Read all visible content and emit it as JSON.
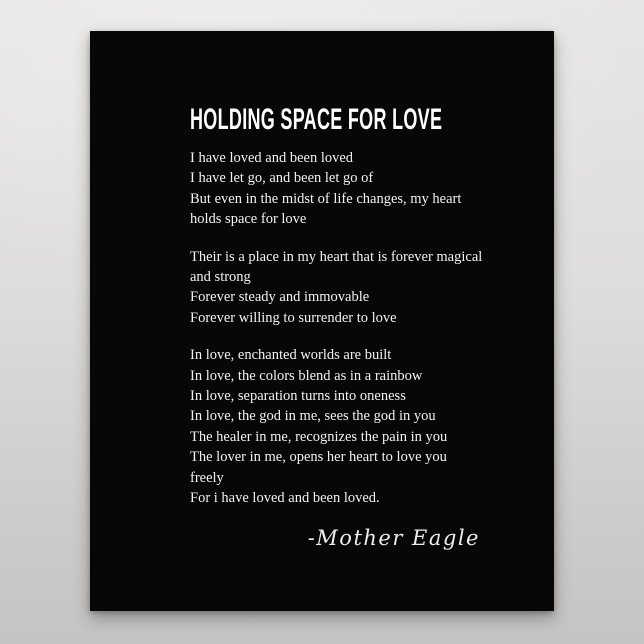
{
  "poster": {
    "title": "HOLDING SPACE FOR LOVE",
    "stanzas": [
      {
        "lines": [
          "I have loved and been loved",
          "I have let go, and been let go of",
          "But even in the midst of life changes, my heart",
          "holds space for love"
        ]
      },
      {
        "lines": [
          "Their is a place in my heart that is forever magical",
          "and strong",
          "Forever steady and immovable",
          "Forever willing to surrender to love"
        ]
      },
      {
        "lines": [
          "In love, enchanted worlds are built",
          "In love, the colors blend as in a rainbow",
          "In love, separation turns into oneness",
          "In love, the god in me, sees the god in you",
          "The healer in me, recognizes the pain in you",
          "The lover in me, opens her heart to love you",
          "freely",
          "For i have loved and been loved."
        ]
      }
    ],
    "signature": "-Mother Eagle",
    "colors": {
      "poster_bg": "#070707",
      "title": "#ffffff",
      "text": "#f2f2f2",
      "backdrop_top": "#e6e5e3",
      "backdrop_bottom": "#c6c4c2"
    }
  }
}
